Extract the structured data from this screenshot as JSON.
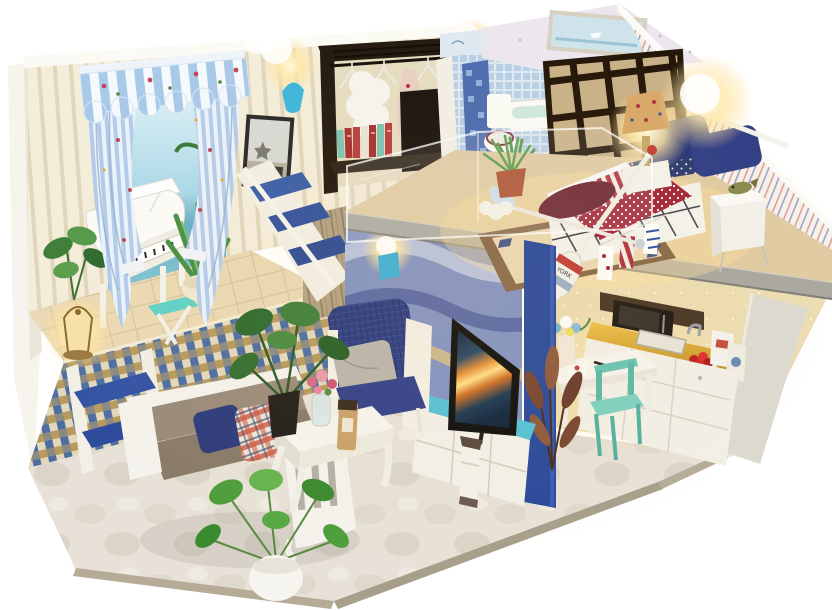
{
  "scene": {
    "description": "Miniature DIY dollhouse diorama photographed on a white background: a two-story blue-and-white coastal loft with piano lounge, wardrobe hall, bathroom, loft bedroom, kitchen and living room, lit by warm miniature lights",
    "theme": "Mediterranean nautical blue and white",
    "background_color": "#ffffff"
  },
  "palette": {
    "wall_cream": "#f3edda",
    "wall_stripe": "#e0d6bc",
    "right_wall_cream": "#f8f1e8",
    "awning_blue": "#a9c9e9",
    "sea_blue": "#68aec6",
    "navy": "#2c3a76",
    "royal_blue": "#2e4c9c",
    "teal_stool": "#5ed2c6",
    "turquoise_cabinet": "#56c2d6",
    "flag_red": "#a32638",
    "counter_gold": "#d9a832",
    "dark_wood": "#241a10",
    "terracotta": "#ad5230",
    "marble_floor": "#e7e1d7",
    "slab_gray": "#a9a8a0",
    "warm_light": "#ffd98a"
  },
  "areas": {
    "lounge": {
      "label": "Piano lounge on raised mosaic platform",
      "objects": [
        "striped scalloped awning",
        "tied floral curtains",
        "beach mural with boat",
        "framed starfish picture",
        "white grand piano",
        "teal stool",
        "snake plant",
        "rubber plant",
        "glowing lantern"
      ]
    },
    "hall": {
      "label": "Wardrobe hall",
      "objects": [
        "dark wood clothes rack",
        "wire hangers",
        "white fur coat",
        "floral dress",
        "row of books",
        "blue wall sconce lights"
      ]
    },
    "bathroom": {
      "label": "Bathroom behind partition",
      "objects": [
        "blue tile walls",
        "white toilet",
        "bathtub",
        "aloe plant in terracotta pot"
      ]
    },
    "bedroom": {
      "label": "Loft bedroom on concrete slab",
      "paddle_text": "YORK",
      "objects": [
        "dark wood grid partition window",
        "bed with American flag quilt",
        "navy pillows",
        "star pennant banner",
        "white nightstand with fish figurine",
        "glowing table lamp",
        "oriental rug",
        "crossed boat paddles",
        "potted grass plant"
      ]
    },
    "kitchen": {
      "label": "Kitchen nook",
      "objects": [
        "white cabinets with gold countertop",
        "sink and faucet",
        "plate of red apples",
        "milk cartons",
        "microwave shelf",
        "white dining table with cake and vase",
        "mint green chairs",
        "dried copper plant"
      ]
    },
    "living_room": {
      "label": "Living room",
      "objects": [
        "white slatted sofa with taupe cushions",
        "red plaid pillow",
        "navy pillows",
        "white coffee table with roses and jar",
        "navy armchair with gray pillow",
        "TV with ocean sunset screen",
        "turquoise-top TV cabinet",
        "lighthouse figurine",
        "pothos plant in white pot",
        "monstera plant",
        "blue step ladder shelf"
      ]
    },
    "stairs": {
      "label": "Staircase with wave mosaic wall",
      "objects": [
        "white stringer stairs with blue treads",
        "weathered plank wall",
        "wavy blue mosaic wall",
        "acrylic loft guard",
        "blue support pillar",
        "blue shaded stair light"
      ]
    }
  }
}
